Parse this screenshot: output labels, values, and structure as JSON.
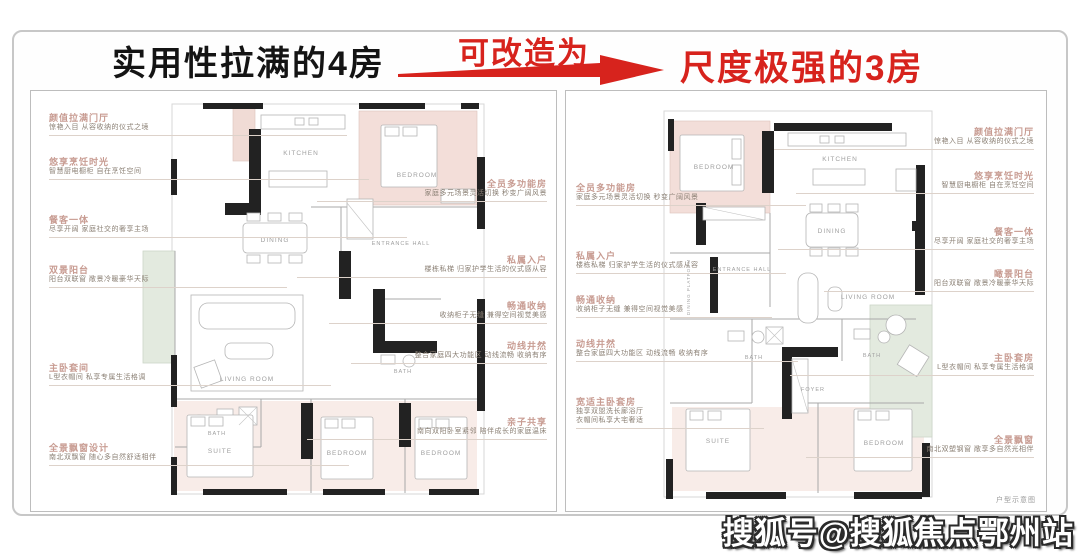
{
  "header": {
    "left_title": "实用性拉满的4房",
    "arrow_label": "可改造为",
    "right_title": "尺度极强的3房",
    "accent_color": "#d7231d",
    "title_color": "#141414"
  },
  "left_panel": {
    "plan_name": "4房户型",
    "rooms": {
      "kitchen": "KITCHEN",
      "dining": "DINING",
      "living": "LIVING ROOM",
      "bedroom_top": "BEDROOM",
      "entrance": "ENTRANCE HALL",
      "bath1": "BATH",
      "bath2": "BATH",
      "suite": "SUITE",
      "bedroom2": "BEDROOM",
      "bedroom3": "BEDROOM"
    },
    "annotations_left": [
      {
        "title": "颜值拉满门厅",
        "desc": "惊艳入目 从容收纳的仪式之境"
      },
      {
        "title": "悠享烹饪时光",
        "desc": "智慧厨电橱柜 自在烹饪空间"
      },
      {
        "title": "餐客一体",
        "desc": "尽享开阔 家庭社交的奢享主场"
      },
      {
        "title": "双景阳台",
        "desc": "阳台双联窗 敞景冷暖豪华天际"
      },
      {
        "title": "主卧套间",
        "desc": "L型衣帽间 私享专属生活格调"
      },
      {
        "title": "全景飘窗设计",
        "desc": "南北双飘窗 随心多自然舒适相伴"
      }
    ],
    "annotations_right": [
      {
        "title": "全员多功能房",
        "desc": "家庭多元场景灵活切换 秒变广阔风景"
      },
      {
        "title": "私属入户",
        "desc": "楼栋私梯 归家护学生活的仪式感从容"
      },
      {
        "title": "畅通收纳",
        "desc": "收纳柜子无缝 兼得空间视觉美感"
      },
      {
        "title": "动线井然",
        "desc": "整合家庭四大功能区 动线流畅 收纳有序"
      },
      {
        "title": "亲子共享",
        "desc": "南向双阳卧室紧邻 陪伴成长的家庭温床"
      }
    ]
  },
  "right_panel": {
    "plan_name": "3房户型",
    "rooms": {
      "bedroom_top": "BEDROOM",
      "kitchen": "KITCHEN",
      "dining": "DINING",
      "living": "LIVING ROOM",
      "entrance": "ENTRANCE HALL",
      "platform": "DINING PLATFORM",
      "foyer": "FOYER",
      "bath1": "BATH",
      "bath2": "BATH",
      "suite": "SUITE",
      "bedroom2": "BEDROOM"
    },
    "annotations_left": [
      {
        "title": "全员多功能房",
        "desc": "家庭多元场景灵活切换 秒变广阔风景"
      },
      {
        "title": "私属入户",
        "desc": "楼栋私梯 归家护学生活的仪式感从容"
      },
      {
        "title": "畅通收纳",
        "desc": "收纳柜子无缝 兼得空间视觉美感"
      },
      {
        "title": "动线井然",
        "desc": "整合家庭四大功能区 动线流畅 收纳有序"
      },
      {
        "title": "宽适主卧套房",
        "desc": "独享双盥洗长廊浴厅",
        "desc2": "衣帽间私享大宅奢适"
      }
    ],
    "annotations_right": [
      {
        "title": "颜值拉满门厅",
        "desc": "惊艳入目 从容收纳的仪式之境"
      },
      {
        "title": "悠享烹饪时光",
        "desc": "智慧厨电橱柜 自在烹饪空间"
      },
      {
        "title": "餐客一体",
        "desc": "尽享开阔 家庭社交的奢享主场"
      },
      {
        "title": "瞰景阳台",
        "desc": "阳台双联窗 敞景冷暖豪华天际"
      },
      {
        "title": "主卧套房",
        "desc": "L型衣帽间 私享专属生活格调"
      },
      {
        "title": "全景飘窗",
        "desc": "南北双塑钢窗 敞享多自然光相伴"
      }
    ],
    "footnote": "户型示意图"
  },
  "watermark": "搜狐号@搜狐焦点鄂州站"
}
